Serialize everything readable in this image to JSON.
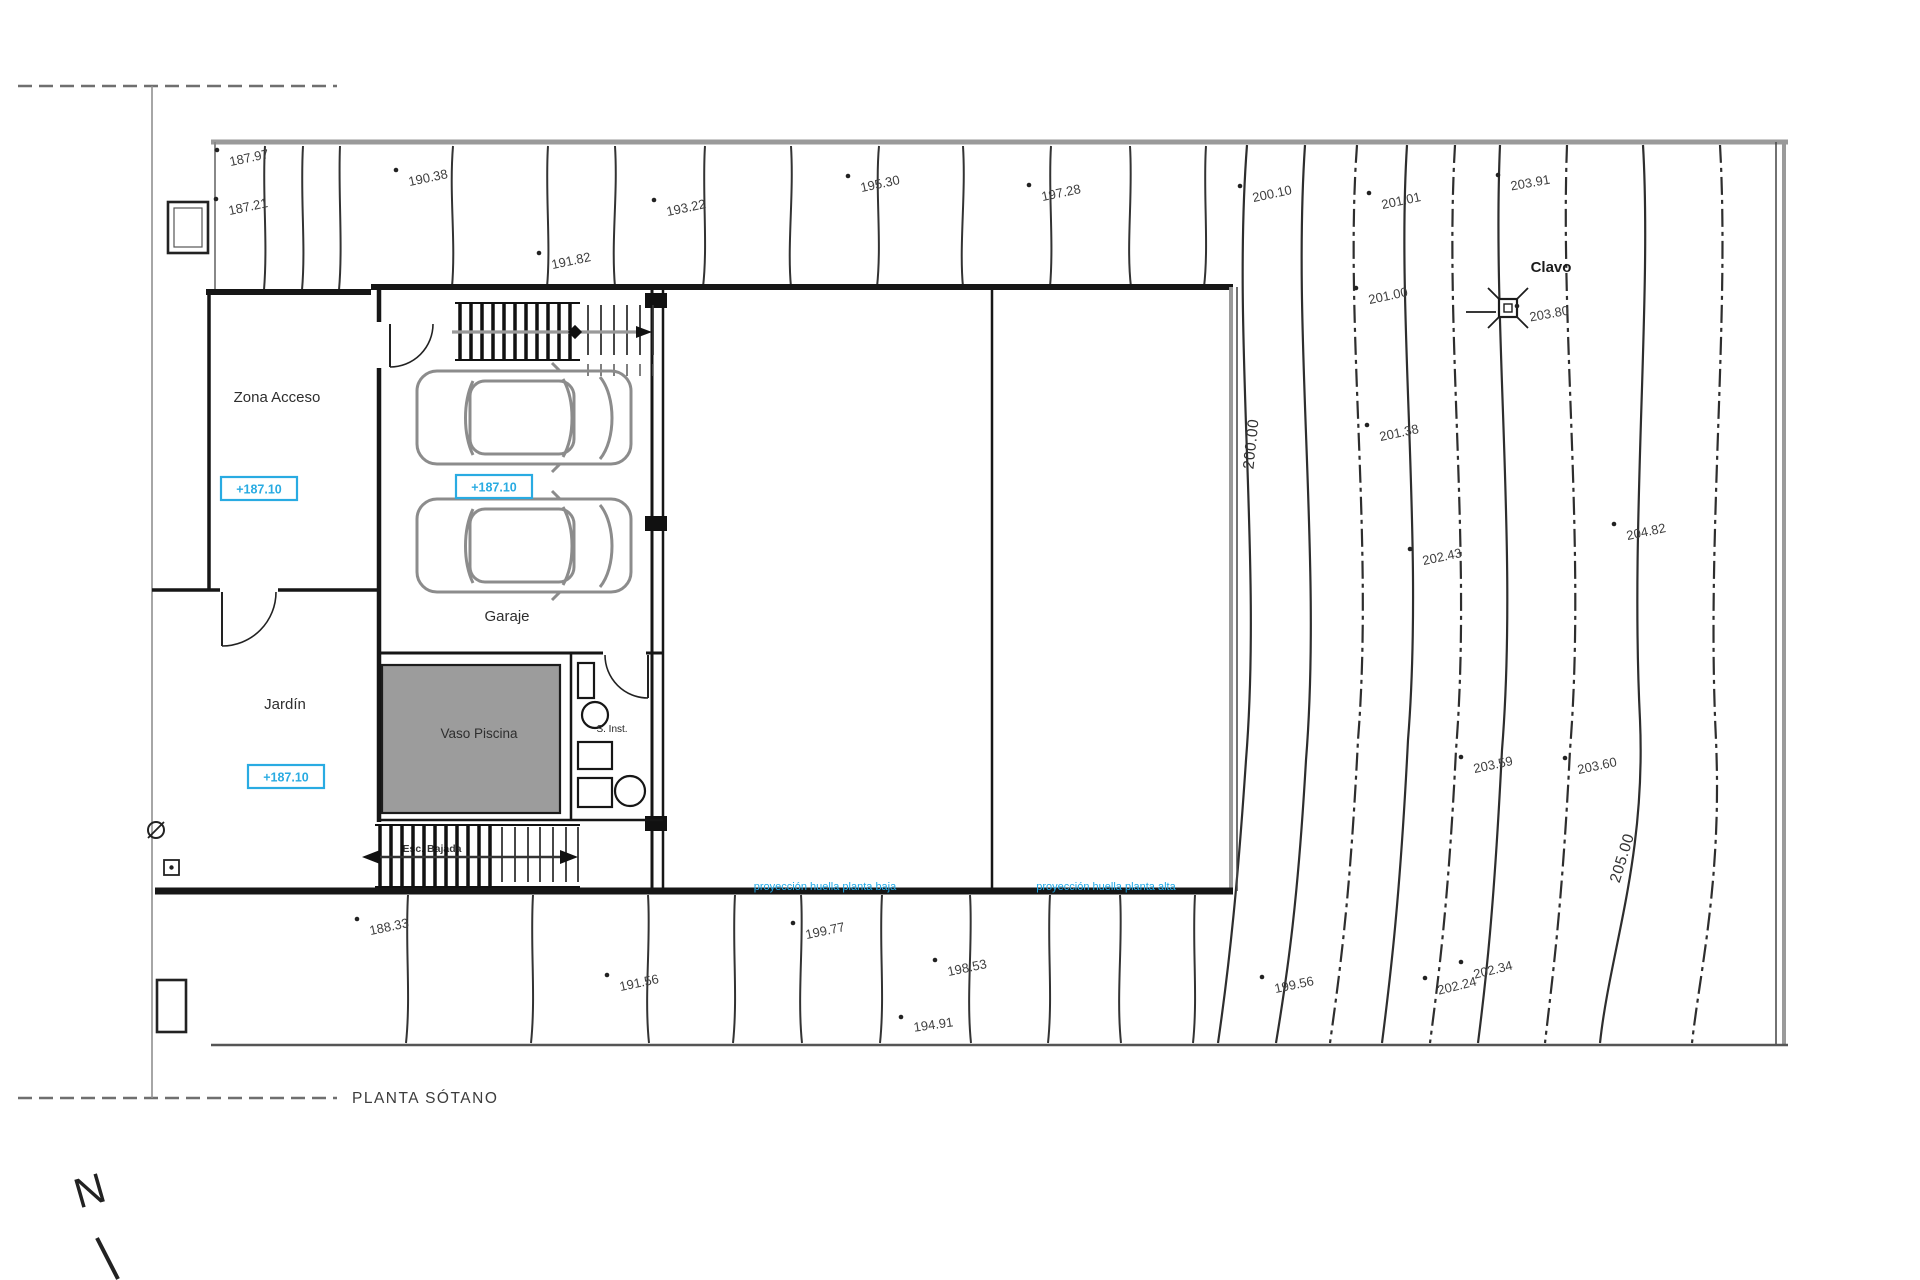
{
  "drawing": {
    "title": "PLANTA SÓTANO",
    "north_label": "N"
  },
  "rooms": {
    "zona_acceso": "Zona Acceso",
    "jardin": "Jardín",
    "garaje": "Garaje",
    "vaso_piscina": "Vaso Piscina",
    "instalaciones": "S. Inst.",
    "stair_label": "Esc. Bajada"
  },
  "levels": [
    {
      "value": "+187.10",
      "x": 259,
      "y": 489
    },
    {
      "value": "+187.10",
      "x": 494,
      "y": 487
    },
    {
      "value": "+187.10",
      "x": 286,
      "y": 777
    }
  ],
  "projections": [
    {
      "label": "proyección huella planta baja"
    },
    {
      "label": "proyección huella planta alta"
    }
  ],
  "benchmark": {
    "label": "Clavo"
  },
  "contour_labels": [
    {
      "value": "200.00"
    },
    {
      "value": "205.00"
    }
  ],
  "spot_elevations": [
    {
      "value": "187.97",
      "x": 250,
      "y": 162,
      "rotation": -12
    },
    {
      "value": "187.21",
      "x": 249,
      "y": 211,
      "rotation": -12
    },
    {
      "value": "190.38",
      "x": 429,
      "y": 182,
      "rotation": -12
    },
    {
      "value": "191.82",
      "x": 572,
      "y": 265,
      "rotation": -12
    },
    {
      "value": "193.22",
      "x": 687,
      "y": 212,
      "rotation": -12
    },
    {
      "value": "195.30",
      "x": 881,
      "y": 188,
      "rotation": -12
    },
    {
      "value": "197.28",
      "x": 1062,
      "y": 197,
      "rotation": -12
    },
    {
      "value": "200.10",
      "x": 1273,
      "y": 198,
      "rotation": -12
    },
    {
      "value": "201.01",
      "x": 1402,
      "y": 205,
      "rotation": -12
    },
    {
      "value": "203.91",
      "x": 1531,
      "y": 187,
      "rotation": -10
    },
    {
      "value": "201.00",
      "x": 1389,
      "y": 300,
      "rotation": -12
    },
    {
      "value": "203.80",
      "x": 1550,
      "y": 318,
      "rotation": -10
    },
    {
      "value": "201.38",
      "x": 1400,
      "y": 437,
      "rotation": -12
    },
    {
      "value": "202.43",
      "x": 1443,
      "y": 561,
      "rotation": -12
    },
    {
      "value": "204.82",
      "x": 1647,
      "y": 536,
      "rotation": -12
    },
    {
      "value": "203.59",
      "x": 1494,
      "y": 769,
      "rotation": -12
    },
    {
      "value": "203.60",
      "x": 1598,
      "y": 770,
      "rotation": -12
    },
    {
      "value": "202.24",
      "x": 1458,
      "y": 990,
      "rotation": -14
    },
    {
      "value": "202.34",
      "x": 1494,
      "y": 974,
      "rotation": -14
    },
    {
      "value": "199.56",
      "x": 1295,
      "y": 989,
      "rotation": -12
    },
    {
      "value": "188.33",
      "x": 390,
      "y": 931,
      "rotation": -12
    },
    {
      "value": "191.56",
      "x": 640,
      "y": 987,
      "rotation": -12
    },
    {
      "value": "199.77",
      "x": 826,
      "y": 935,
      "rotation": -12
    },
    {
      "value": "198.53",
      "x": 968,
      "y": 972,
      "rotation": -12
    },
    {
      "value": "194.91",
      "x": 934,
      "y": 1029,
      "rotation": -8
    }
  ],
  "colors": {
    "accent_cyan": "#29abe2",
    "projection_blue": "#1fa9e8",
    "wall_dark": "#161616",
    "wall_gray": "#9a9a9a",
    "pool_fill": "#9c9c9c",
    "contour": "#2e2e2e"
  }
}
